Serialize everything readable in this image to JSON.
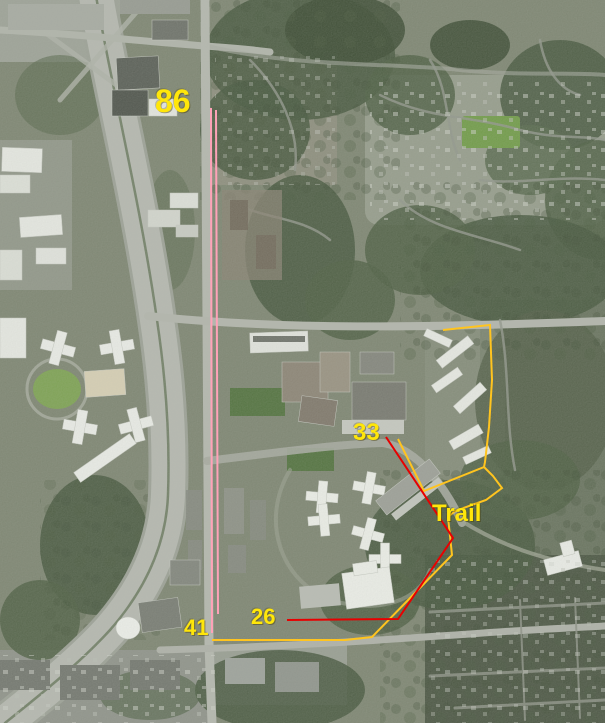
{
  "map": {
    "kind": "aerial-satellite-annotated",
    "label_color": "#ffe60a",
    "labels": [
      {
        "text": "86",
        "x": 155,
        "y": 85,
        "size": 32
      },
      {
        "text": "33",
        "x": 353,
        "y": 421,
        "size": 24
      },
      {
        "text": "Trail",
        "x": 432,
        "y": 502,
        "size": 24
      },
      {
        "text": "26",
        "x": 251,
        "y": 606,
        "size": 22
      },
      {
        "text": "41",
        "x": 184,
        "y": 617,
        "size": 22
      }
    ],
    "route_colors": {
      "yellow": "#ffc41f",
      "red": "#e80000",
      "pink": "#ffa2b8"
    },
    "routes": [
      {
        "name": "boundary-route-yellow",
        "color": "#ffc41f",
        "width": 2,
        "points": [
          [
            398,
            439
          ],
          [
            424,
            491
          ],
          [
            484,
            467
          ],
          [
            485,
            462
          ],
          [
            489,
            427
          ],
          [
            492,
            380
          ],
          [
            490,
            325
          ],
          [
            443,
            330
          ]
        ]
      },
      {
        "name": "trail-route-yellow",
        "color": "#ffc41f",
        "width": 2,
        "points": [
          [
            484,
            467
          ],
          [
            493,
            476
          ],
          [
            502,
            488
          ],
          [
            486,
            500
          ],
          [
            455,
            511
          ],
          [
            448,
            517
          ],
          [
            452,
            555
          ],
          [
            372,
            637
          ],
          [
            345,
            640
          ],
          [
            212,
            640
          ]
        ]
      },
      {
        "name": "trail-route-red",
        "color": "#e80000",
        "width": 2,
        "points": [
          [
            386,
            437
          ],
          [
            453,
            538
          ],
          [
            398,
            619
          ],
          [
            287,
            620
          ]
        ]
      },
      {
        "name": "corridor-line-pink-left",
        "color": "#ffa2b8",
        "width": 2,
        "points": [
          [
            211,
            108
          ],
          [
            212,
            633
          ]
        ]
      },
      {
        "name": "corridor-line-pink-right",
        "color": "#ffa2b8",
        "width": 2,
        "points": [
          [
            216,
            110
          ],
          [
            218,
            614
          ]
        ]
      }
    ]
  }
}
